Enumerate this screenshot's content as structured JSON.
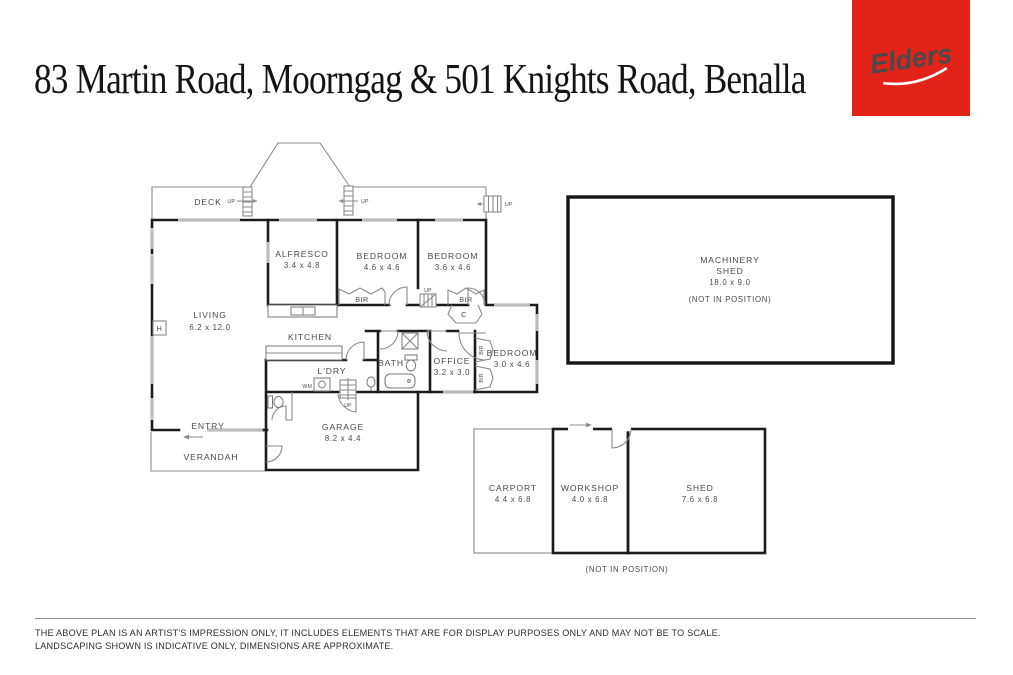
{
  "header": {
    "title": "83 Martin Road, Moorngag & 501 Knights Road, Benalla",
    "logo_text": "Elders",
    "logo_color": "#E2231A"
  },
  "plan": {
    "rooms": {
      "deck": {
        "name": "DECK"
      },
      "alfresco": {
        "name": "ALFRESCO",
        "dims": "3.4 x 4.8"
      },
      "bedroom1": {
        "name": "BEDROOM",
        "dims": "4.6 x 4.6"
      },
      "bedroom2": {
        "name": "BEDROOM",
        "dims": "3.6 x 4.6"
      },
      "living": {
        "name": "LIVING",
        "dims": "6.2 x 12.0"
      },
      "kitchen": {
        "name": "KITCHEN"
      },
      "ldry": {
        "name": "L'DRY"
      },
      "bath": {
        "name": "BATH"
      },
      "office": {
        "name": "OFFICE",
        "dims": "3.2 x 3.0"
      },
      "bedroom3": {
        "name": "BEDROOM",
        "dims": "3.0 x 4.6"
      },
      "garage": {
        "name": "GARAGE",
        "dims": "8.2 x 4.4"
      },
      "entry": {
        "name": "ENTRY"
      },
      "verandah": {
        "name": "VERANDAH"
      }
    },
    "markers": {
      "up": "UP",
      "bir": "BIR",
      "cupboard": "C",
      "hws": "H",
      "wm": "WM"
    },
    "outbuildings": {
      "machinery_shed": {
        "name_line1": "MACHINERY",
        "name_line2": "SHED",
        "dims": "18.0 x 9.0",
        "note": "(NOT IN POSITION)"
      },
      "carport": {
        "name": "CARPORT",
        "dims": "4.4 x 6.8"
      },
      "workshop": {
        "name": "WORKSHOP",
        "dims": "4.0 x 6.8"
      },
      "shed": {
        "name": "SHED",
        "dims": "7.6 x 6.8"
      },
      "group_note": "(NOT IN POSITION)"
    }
  },
  "footer": {
    "line1": "THE ABOVE PLAN IS AN ARTIST'S IMPRESSION ONLY, IT INCLUDES ELEMENTS THAT ARE FOR DISPLAY PURPOSES ONLY AND MAY NOT BE TO SCALE.",
    "line2": "LANDSCAPING SHOWN IS INDICATIVE ONLY, DIMENSIONS ARE APPROXIMATE."
  }
}
